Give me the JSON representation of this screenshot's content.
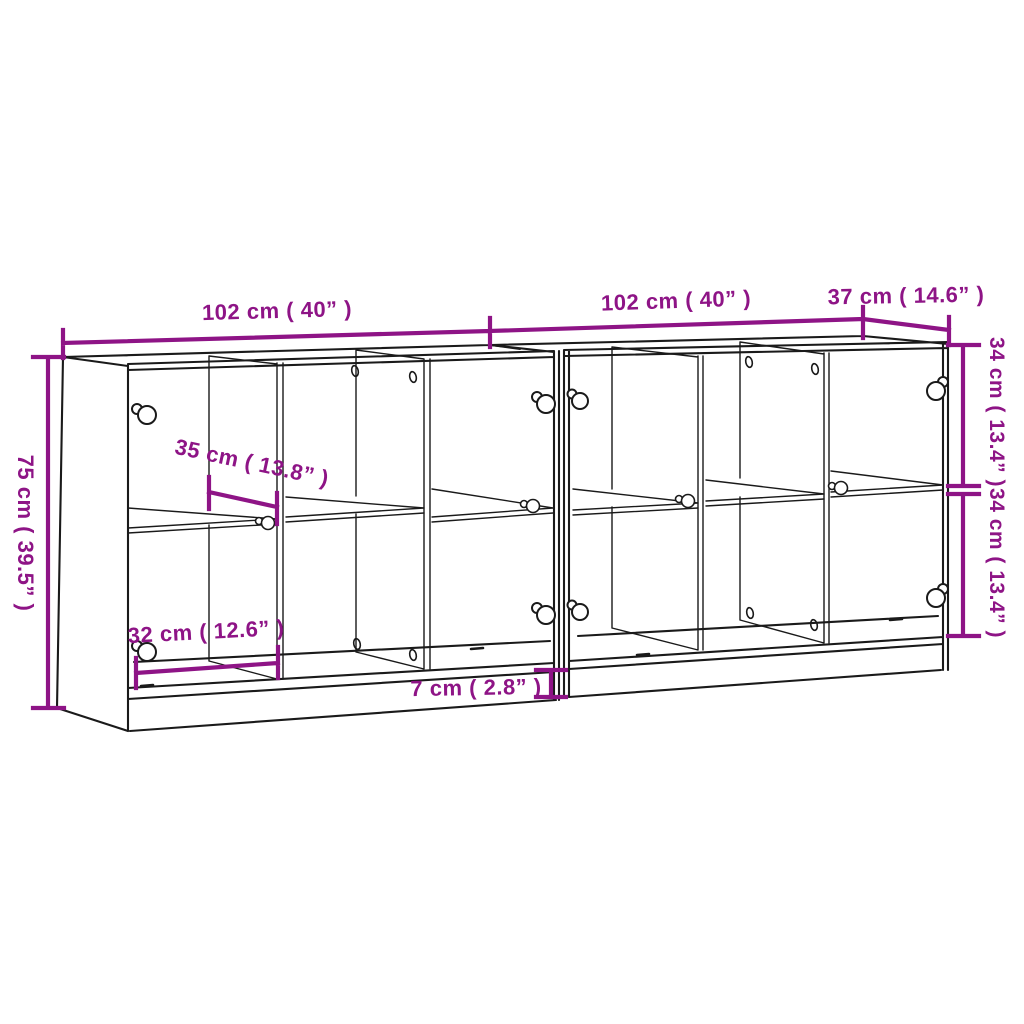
{
  "colors": {
    "accent": "#8E1486",
    "line": "#1a1a1a",
    "background": "#ffffff"
  },
  "diagram": {
    "type": "furniture-dimension-drawing",
    "object": "two-unit bookcase sideboard with glass doors, 3 columns and mid shelf per unit"
  },
  "dimensions": {
    "width_left_label": "102 cm ( 40” )",
    "width_right_label": "102 cm ( 40” )",
    "depth_label": "37 cm ( 14.6” )",
    "height_label": "75 cm ( 39.5” )",
    "upper_inner_height_label": "34 cm ( 13.4” )",
    "lower_inner_height_label": "34 cm ( 13.4” )",
    "inner_width_label": "35 cm ( 13.8” )",
    "lower_inner_width_label": "32 cm ( 12.6” )",
    "plinth_height_label": "7 cm ( 2.8” )"
  }
}
